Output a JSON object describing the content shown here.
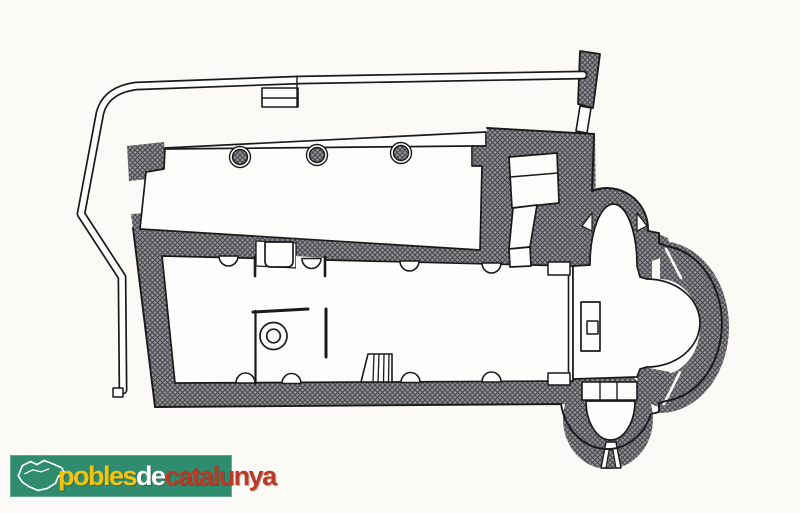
{
  "page": {
    "background": "#fbfaf7",
    "paper": "#fdfdfb"
  },
  "logo": {
    "background": "#2f8c6e",
    "words": [
      {
        "text": "pobles",
        "color": "#f2c50f"
      },
      {
        "text": "de",
        "color": "#ffffff"
      },
      {
        "text": "catalunya",
        "color": "#b93a27"
      }
    ],
    "map_icon": "catalonia-outline",
    "map_color": "#ffffff"
  },
  "plan": {
    "ink": "#1a1a1c",
    "wall_fill": "#909094",
    "wall_hatch": "#46464a",
    "elements": [
      "precinct-wall",
      "buttress",
      "north-hall",
      "hall-columns",
      "nave",
      "north-door",
      "baptistery-enclosure",
      "baptismal-font",
      "stairs",
      "tower",
      "tower-stair-room",
      "chancel",
      "chancel-step",
      "altar",
      "presbytery-steps",
      "trefoil-apse",
      "north-apse-chapel",
      "main-apse",
      "south-apse-chapel",
      "apse-window"
    ]
  }
}
